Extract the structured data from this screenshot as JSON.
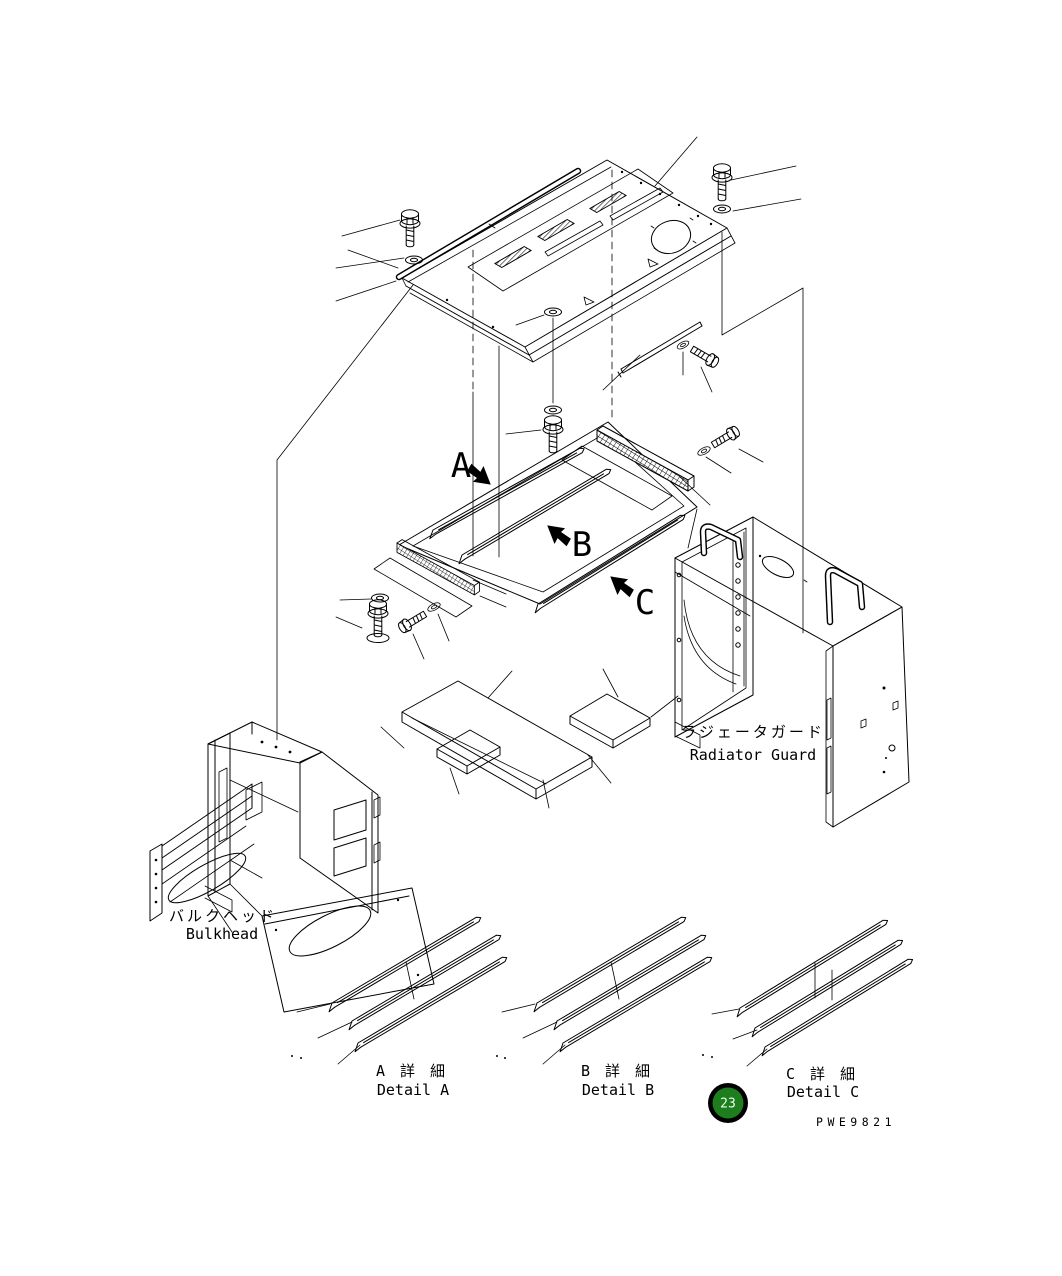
{
  "canvas": {
    "background": "#ffffff",
    "line_color": "#000000"
  },
  "diagram": {
    "section_markers": [
      {
        "letter": "A"
      },
      {
        "letter": "B"
      },
      {
        "letter": "C"
      }
    ],
    "part_labels": {
      "radiator_guard": {
        "jp": "ラジェータガード",
        "en": "Radiator Guard"
      },
      "bulkhead": {
        "jp": "バルクヘッド",
        "en": "Bulkhead"
      }
    },
    "detail_captions": {
      "a": {
        "jp": "A 詳 細",
        "en": "Detail A"
      },
      "b": {
        "jp": "B 詳 細",
        "en": "Detail B"
      },
      "c": {
        "jp": "C 詳 細",
        "en": "Detail C"
      }
    },
    "callout": {
      "number": "23",
      "fill": "#1e7e1e",
      "ring": "#000000",
      "text_color": "#eafcea"
    },
    "drawing_number": "PWE9821"
  }
}
